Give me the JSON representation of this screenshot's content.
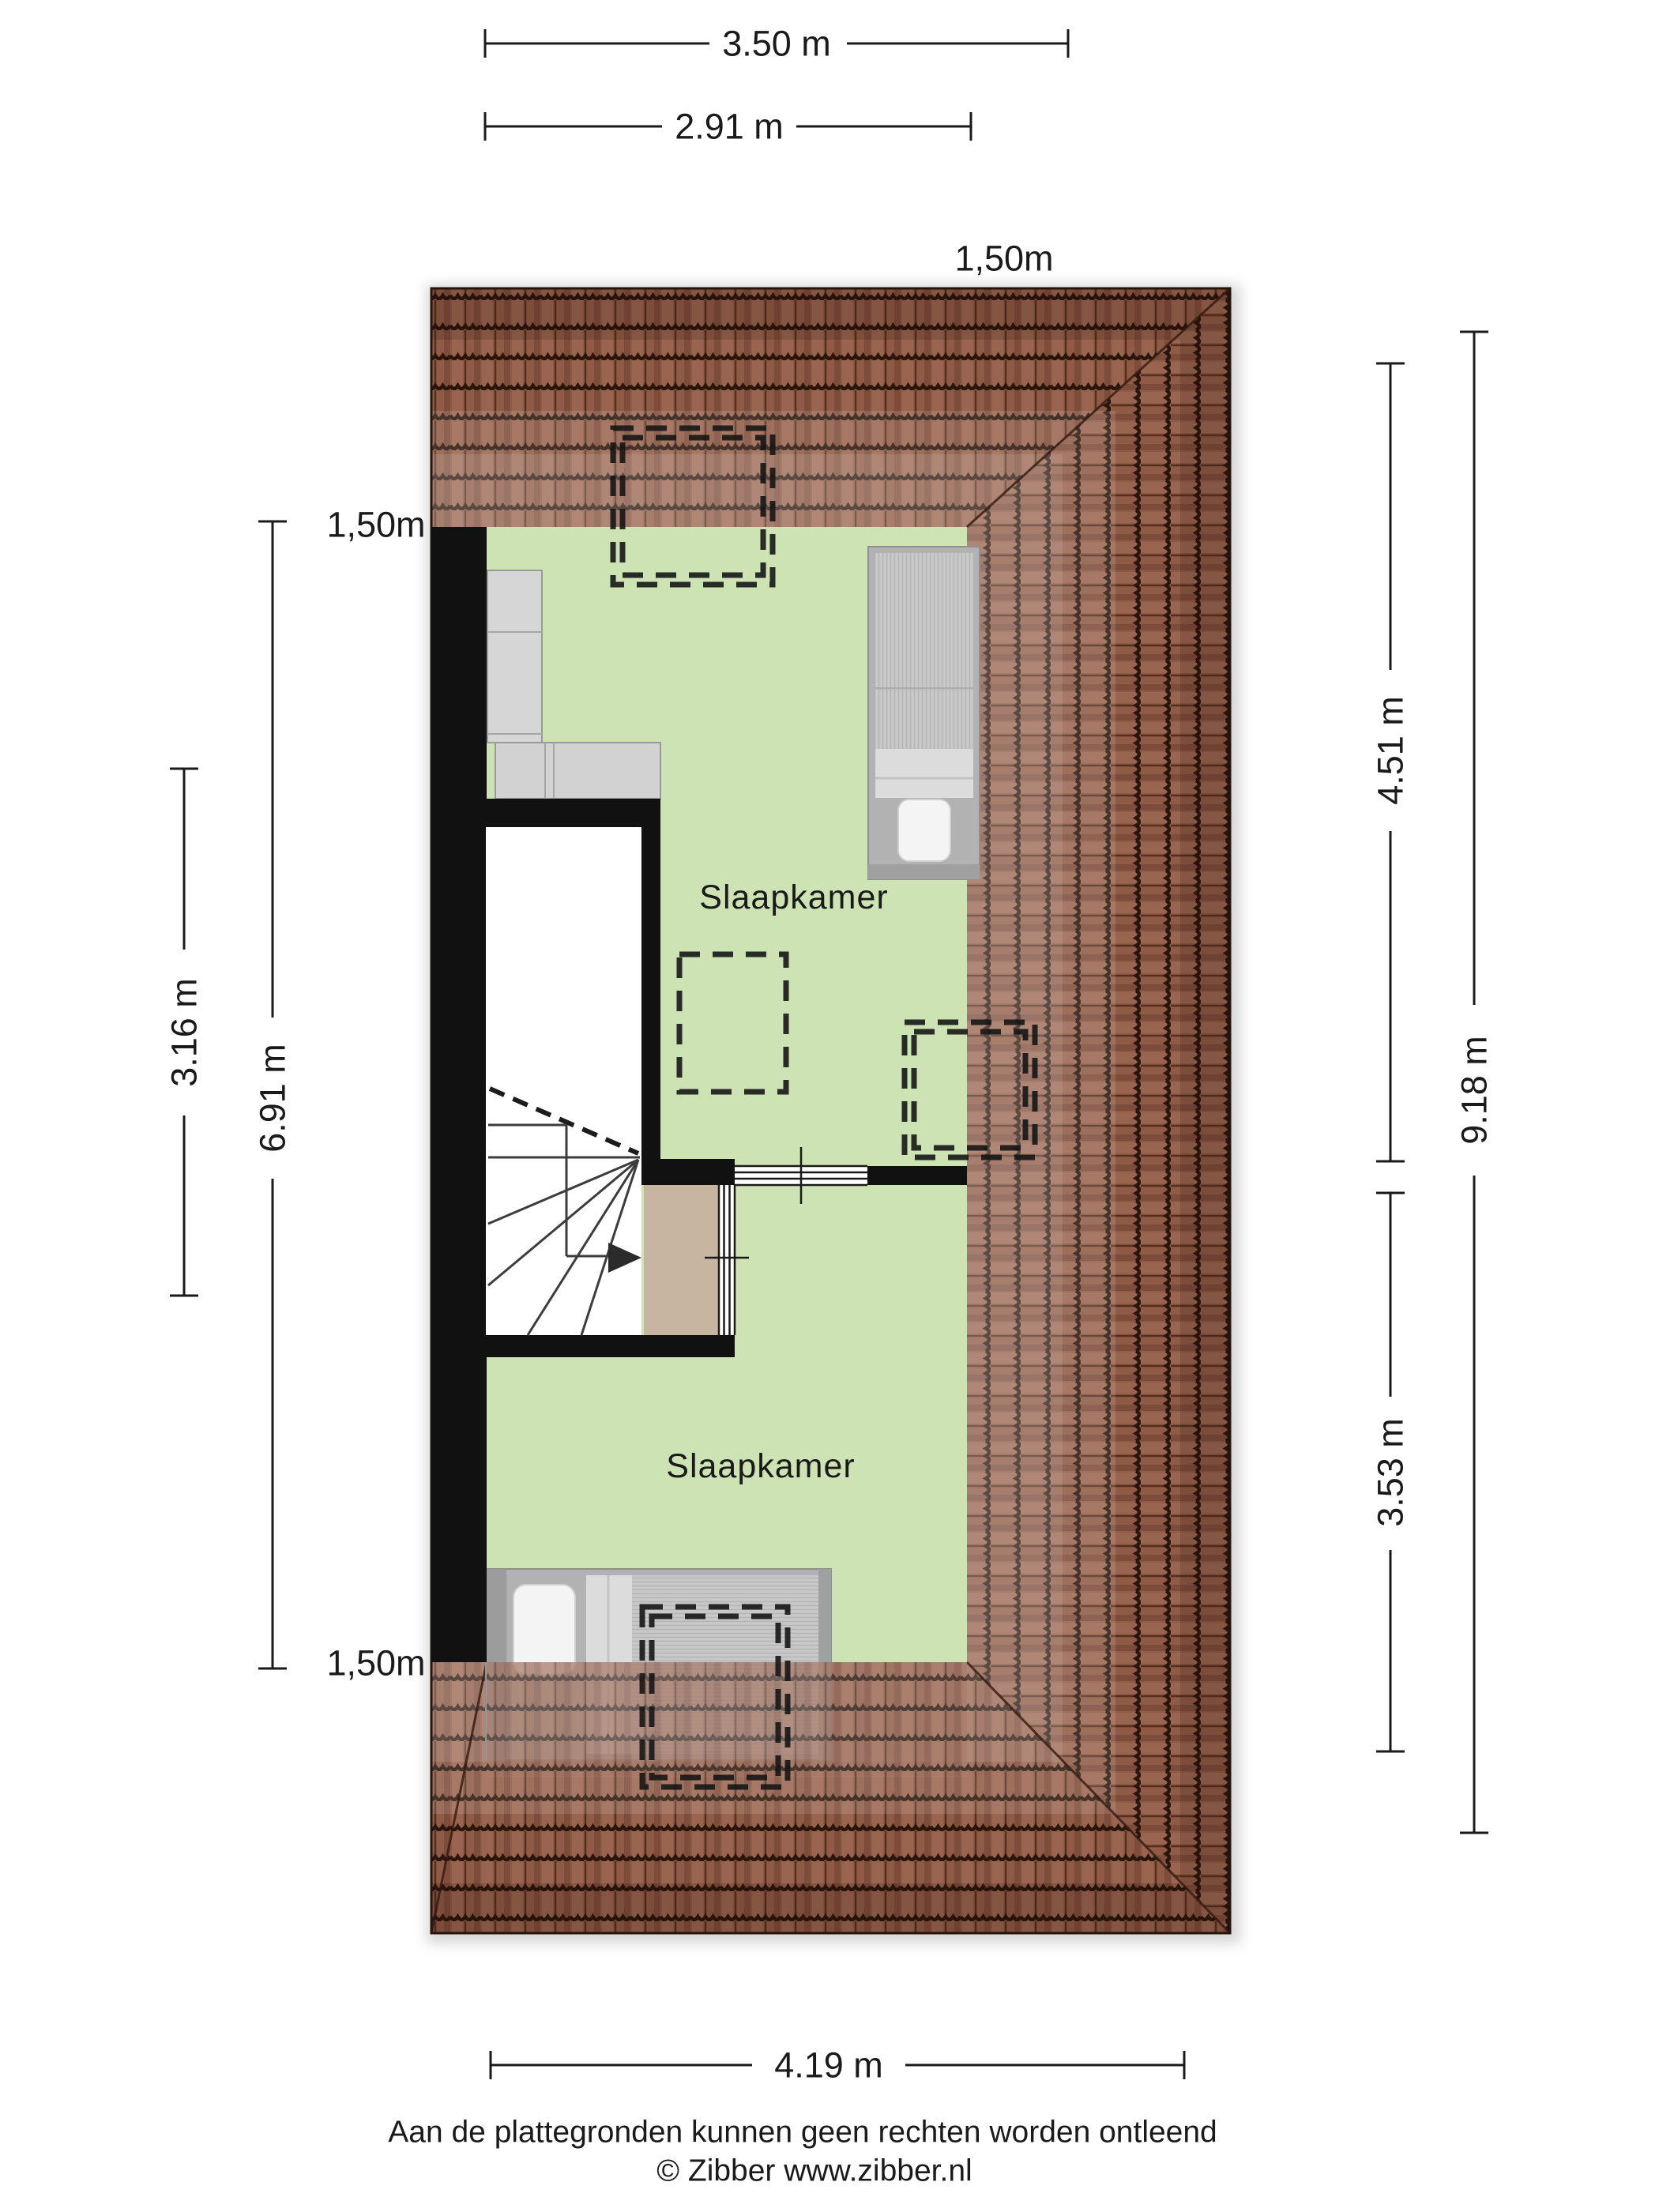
{
  "plan": {
    "type": "attic floor plan",
    "rooms": [
      {
        "id": "bedroom-1",
        "label": "Slaapkamer"
      },
      {
        "id": "bedroom-2",
        "label": "Slaapkamer"
      }
    ],
    "height_markers": {
      "top_right": "1,50m",
      "upper_left": "1,50m",
      "lower_left": "1,50m"
    }
  },
  "dimensions": {
    "top_total": "3.50 m",
    "top_inner": "2.91 m",
    "left_total": "6.91 m",
    "left_inner": "3.16 m",
    "right_upper": "4.51 m",
    "right_lower": "3.53 m",
    "right_total": "9.18 m",
    "bottom": "4.19 m"
  },
  "footer": {
    "disclaimer": "Aan de plattegronden kunnen geen rechten worden ontleend",
    "copyright": "© Zibber www.zibber.nl"
  },
  "colors": {
    "floor": "#cde3b3",
    "roof_tile": "#8f5a46",
    "roof_tile_light": "#9a6550",
    "roof_tile_dark": "#7e4c3b",
    "roof_joint": "#552f1e",
    "roof_wave": "#2a150b",
    "wall": "#111111",
    "landing": "#c7b5a2",
    "stairwell": "#ffffff",
    "furniture": "#c6c6c6"
  }
}
